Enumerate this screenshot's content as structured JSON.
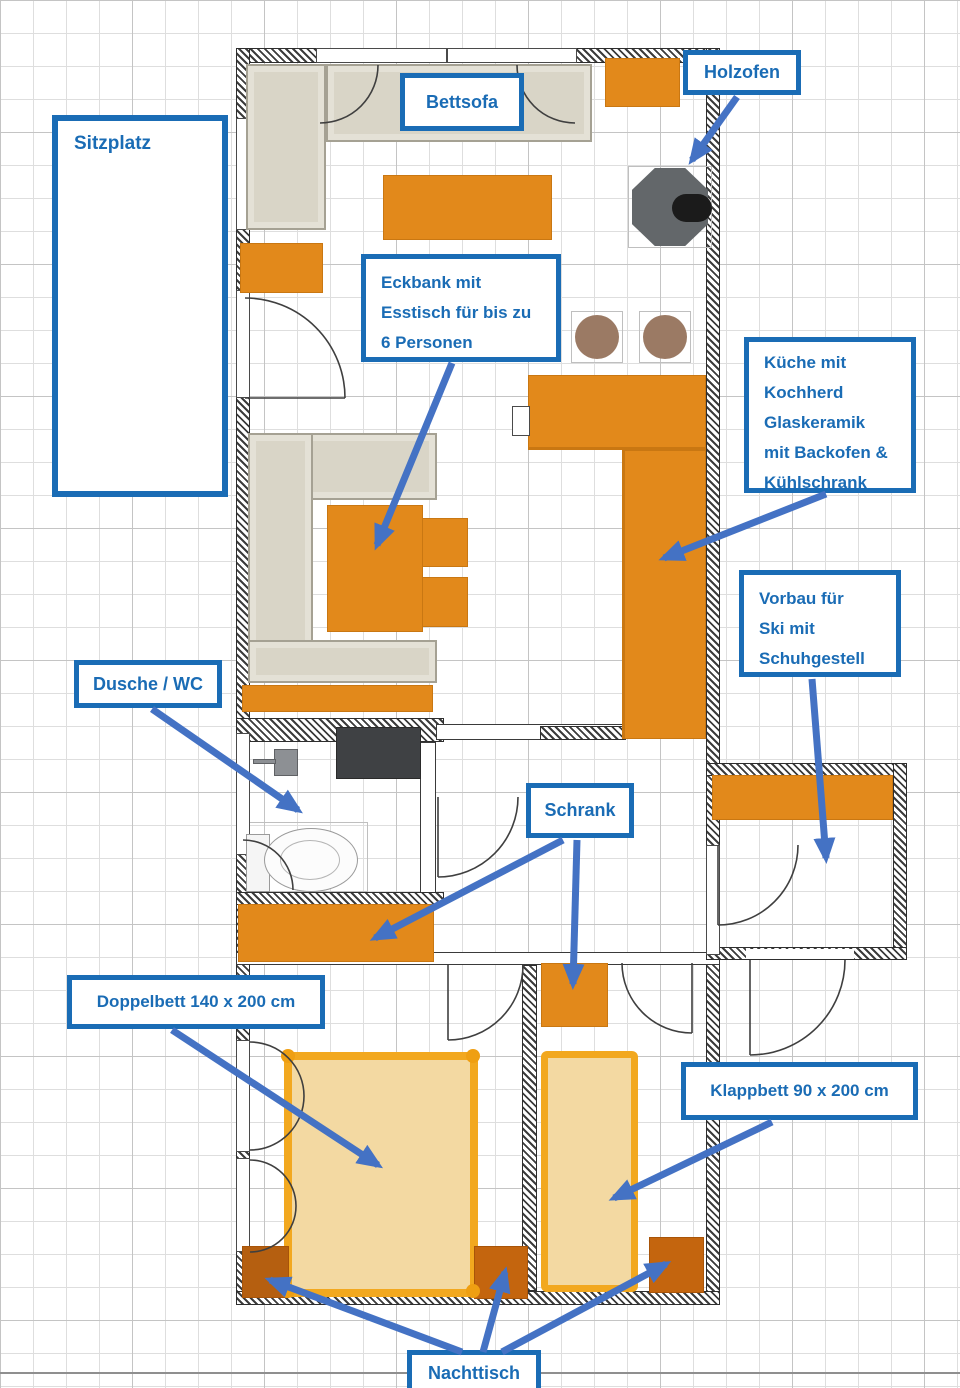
{
  "page": {
    "type": "annotated floor plan",
    "language": "de"
  },
  "annotations": {
    "sitzplatz": {
      "text": "Sitzplatz"
    },
    "bettsofa": {
      "text": "Bettsofa"
    },
    "holzofen": {
      "text": "Holzofen"
    },
    "eckbank": {
      "line1": "Eckbank mit",
      "line2": "Esstisch für bis zu",
      "line3": "6 Personen"
    },
    "kueche": {
      "line1": "Küche mit",
      "line2": "Kochherd",
      "line3": "Glaskeramik",
      "line4": "mit Backofen &",
      "line5": "Kühlschrank"
    },
    "vorbau": {
      "line1": "Vorbau für",
      "line2": "Ski mit",
      "line3": "Schuhgestell"
    },
    "dusche_wc": {
      "text": "Dusche / WC"
    },
    "schrank": {
      "text": "Schrank"
    },
    "doppelbett": {
      "text": "Doppelbett 140 x 200 cm"
    },
    "klappbett": {
      "text": "Klappbett 90 x 200 cm"
    },
    "nachttisch": {
      "text": "Nachttisch"
    }
  },
  "colors": {
    "label_border": "#1a6cb5",
    "label_text": "#1a6cb5",
    "arrow_blue": "#4472c4",
    "furniture_orange": "#e2891b",
    "furniture_dark_orange": "#c4650e",
    "bed_frame": "#f2a81f",
    "bed_fill": "#f3d9a2",
    "bench_beige": "#d9d5c7",
    "stove_gray": "#63676a",
    "stool_brown": "#9b7a64",
    "wall_hatch": "#3c3c3c",
    "grid_line": "#dedede"
  },
  "furniture_items": [
    "corner-sofa",
    "coffee-table",
    "sideboard",
    "wood-stove",
    "wall-shelf",
    "corner-bench",
    "dining-table",
    "dining-chairs",
    "kitchen-counter",
    "bar-stools",
    "shower",
    "washbasin",
    "toilet",
    "wardrobe",
    "hall-wardrobe",
    "shoe-shelf",
    "double-bed",
    "fold-bed",
    "nightstands"
  ]
}
